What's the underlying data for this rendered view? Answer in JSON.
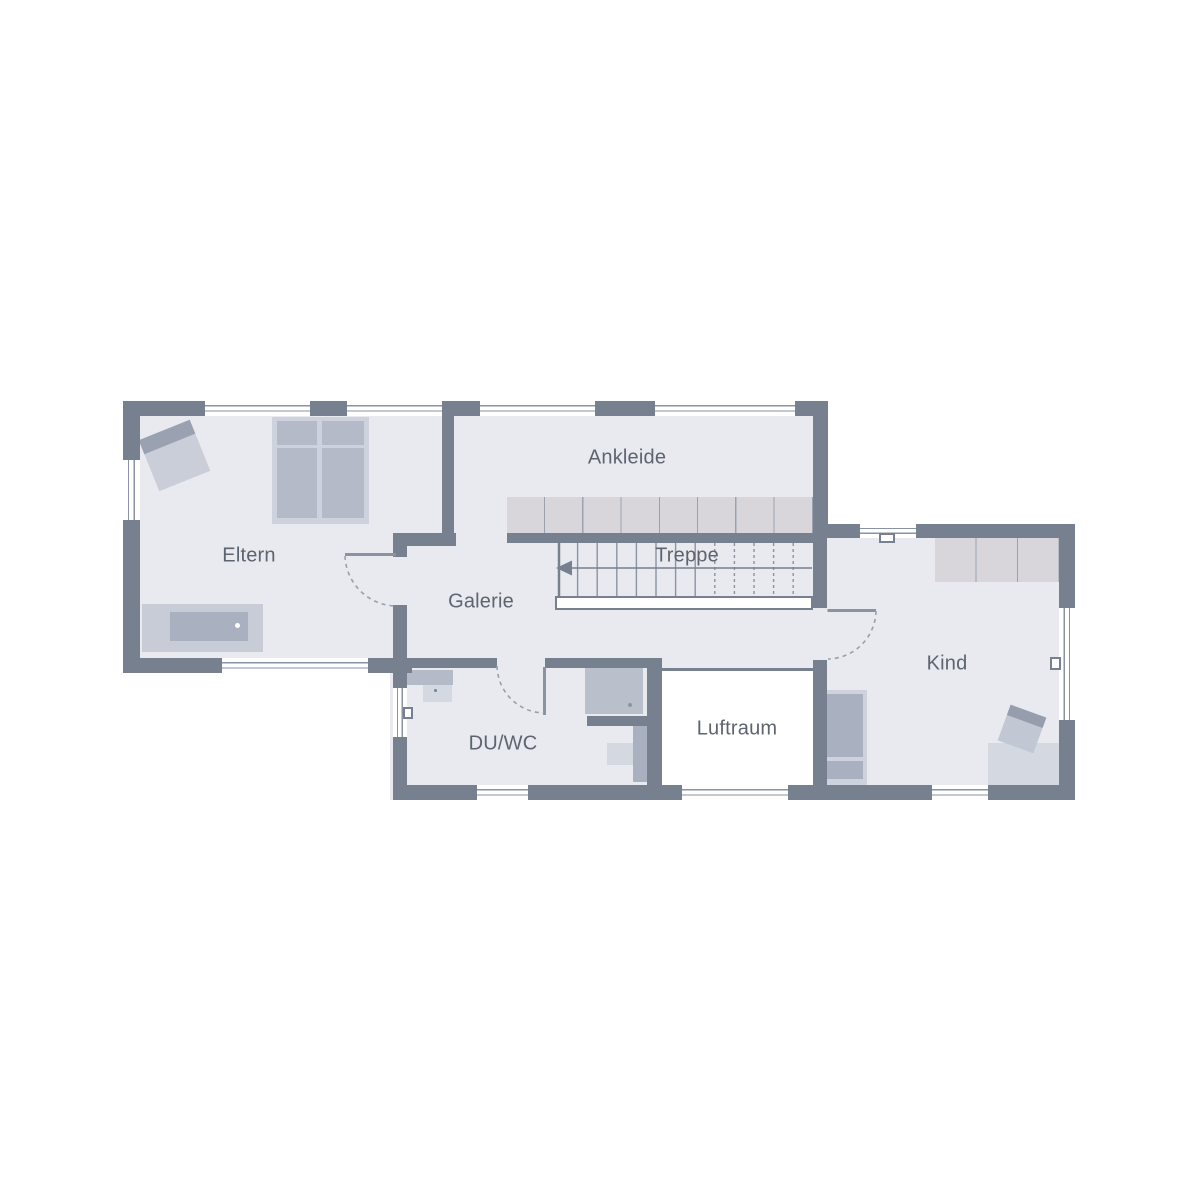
{
  "rooms": {
    "eltern": {
      "label": "Eltern"
    },
    "ankleide": {
      "label": "Ankleide"
    },
    "treppe": {
      "label": "Treppe"
    },
    "galerie": {
      "label": "Galerie"
    },
    "duwc": {
      "label": "DU/WC"
    },
    "luftraum": {
      "label": "Luftraum"
    },
    "kind": {
      "label": "Kind"
    }
  },
  "colors": {
    "wall": "#76808F",
    "floor": "#E8EAEF",
    "line": "#8A93A2",
    "text": "#5D6470",
    "wardrobe": "#D9D6DB",
    "furn_light": "#CDD2DC",
    "furn_mid": "#B4BAC7",
    "furn_dark": "#A9B0BF",
    "window": "#FFFFFF"
  }
}
